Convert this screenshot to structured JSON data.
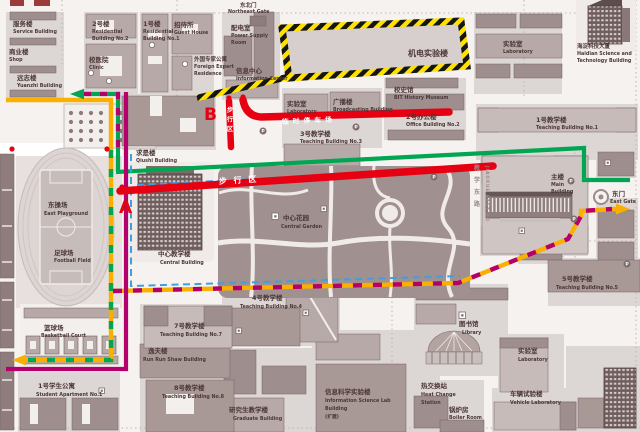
{
  "markers": {
    "a": "A",
    "b": "B"
  },
  "gates": {
    "northeast": {
      "zh": "东北门",
      "en": "Northeast Gate"
    },
    "east": {
      "zh": "东门",
      "en": "East Gate"
    }
  },
  "roads": {
    "pedestrian_zone_h": "步 行 区",
    "pedestrian_zone_v": "步行区",
    "temp_parking": "临时停车场",
    "jiaoxue_zh": "教学东路",
    "jiaoxue_en": "JIAOXUE EAST RD"
  },
  "icons": {
    "parking": "P"
  },
  "colors": {
    "route_red": "#e60012",
    "route_green": "#00a651",
    "route_yellow": "#f9b000",
    "route_magenta": "#b4006c",
    "route_blue": "#3fa0dc",
    "hazard_yellow": "#ffe100"
  },
  "labels": {
    "service": {
      "zh": "服务楼",
      "en": "Service Building"
    },
    "shop": {
      "zh": "商业楼",
      "en": "Shop"
    },
    "yuanzhi": {
      "zh": "远志楼",
      "en": "Yuanzhi Building"
    },
    "residential2": {
      "zh": "2号楼",
      "en1": "Residential",
      "en2": "Building No.2"
    },
    "residential1": {
      "zh": "1号楼",
      "en1": "Residential",
      "en2": "Building No.1"
    },
    "clinic": {
      "zh": "校医院",
      "en": "Clinic"
    },
    "guest_house": {
      "zh": "招待所",
      "en": "Guest House"
    },
    "foreign_expert": {
      "zh": "外国专家公寓",
      "en1": "Foreign Expert",
      "en2": "Residence"
    },
    "power_supply": {
      "zh": "配电室",
      "en1": "Power Supply",
      "en2": "Room"
    },
    "info_center": {
      "zh": "信息中心",
      "en": "Information Center"
    },
    "jidian_lab": {
      "zh": "机电实验楼"
    },
    "laboratory_n": {
      "zh": "实验室",
      "en": "Laboratory"
    },
    "haidian": {
      "zh": "海淀科技大厦",
      "en1": "Haidian Science and",
      "en2": "Technology Building"
    },
    "history_museum": {
      "zh": "校史馆",
      "en": "BIT History Museum"
    },
    "office2": {
      "zh": "2号办公楼",
      "en": "Office Building No.2"
    },
    "teaching1": {
      "zh": "1号教学楼",
      "en": "Teaching Building No.1"
    },
    "laboratory_m": {
      "zh": "实验室",
      "en": "Laboratory"
    },
    "broadcasting": {
      "zh": "广播楼",
      "en": "Broadcasting Building"
    },
    "teaching3": {
      "zh": "3号教学楼",
      "en": "Teaching Building No.3"
    },
    "qiushi": {
      "zh": "求是楼",
      "en": "Qiushi Building"
    },
    "east_playground": {
      "zh": "东操场",
      "en": "East Playground"
    },
    "football": {
      "zh": "足球场",
      "en": "Football Field"
    },
    "central_building": {
      "zh": "中心教学楼",
      "en": "Central Building"
    },
    "central_garden": {
      "zh": "中心花园",
      "en": "Central Garden"
    },
    "main_building": {
      "zh": "主楼",
      "en1": "Main",
      "en2": "Building"
    },
    "teaching5": {
      "zh": "5号教学楼",
      "en": "Teaching Building No.5"
    },
    "basketball": {
      "zh": "篮球场",
      "en": "Basketball Court"
    },
    "student_apt1": {
      "zh": "1号学生公寓",
      "en": "Student Apartment No.1"
    },
    "teaching7": {
      "zh": "7号教学楼",
      "en": "Teaching Building No.7"
    },
    "runrunshaw": {
      "zh": "逸夫楼",
      "en": "Run Run Shaw Building"
    },
    "teaching8": {
      "zh": "8号教学楼",
      "en": "Teaching Building No.8"
    },
    "teaching4": {
      "zh": "4号教学楼",
      "en": "Teaching Building No.4"
    },
    "graduate": {
      "zh": "研究生教学楼",
      "en": "Graduate Building"
    },
    "info_science": {
      "zh": "信息科学实验楼",
      "en1": "Information Science Lab",
      "en2": "Building",
      "en3": "(扩建)"
    },
    "heat_station": {
      "zh": "热交换站",
      "en1": "Heat Change",
      "en2": "Station"
    },
    "boiler": {
      "zh": "锅炉房",
      "en": "Boiler Room"
    },
    "library": {
      "zh": "图书馆",
      "en": "Library"
    },
    "laboratory_s": {
      "zh": "实验室",
      "en": "Laboratory"
    },
    "vehicle_lab": {
      "zh": "车辆试验楼",
      "en": "Vehicle Laboratory"
    }
  }
}
